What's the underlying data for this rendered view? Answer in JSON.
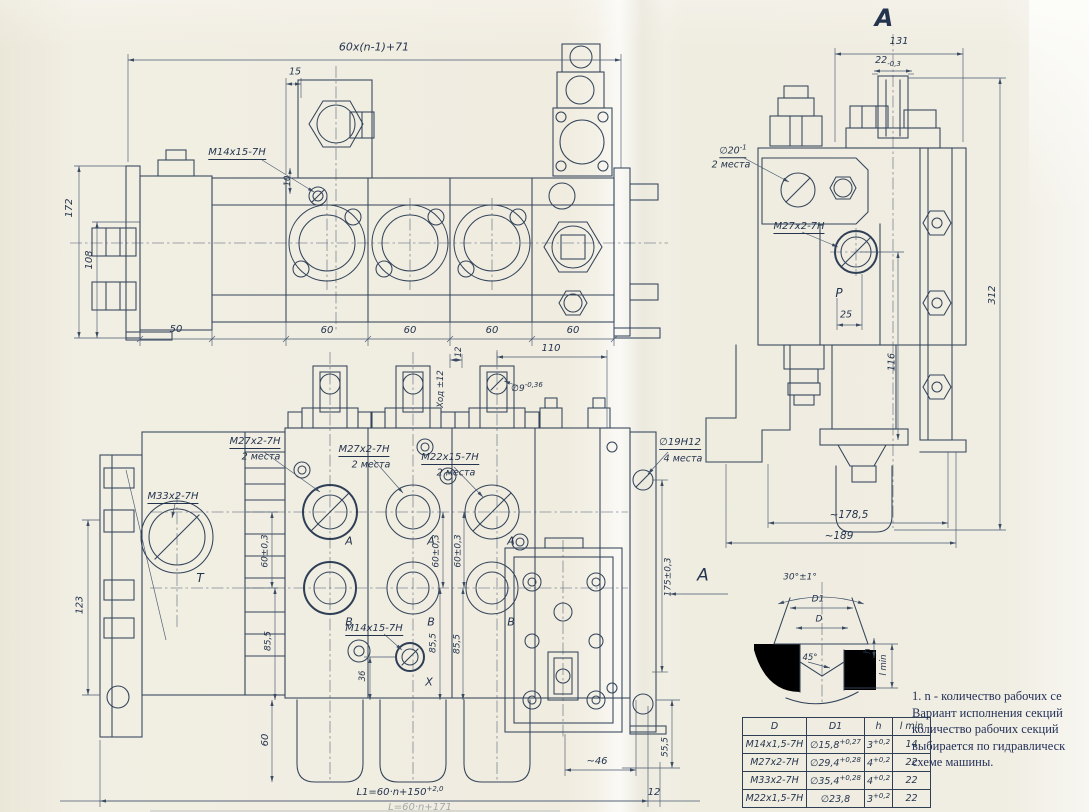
{
  "front": {
    "dim_overall": "60x(n-1)+71",
    "dim_15": "15",
    "callout_m14": "M14x15-7H",
    "dim_10": "10",
    "dim_172": "172",
    "dim_108": "108",
    "dim_50": "50",
    "dim_60": "60"
  },
  "view_a": {
    "title": "A",
    "dim_131": "131",
    "dim_22": "22",
    "dim_22_tol": "-0,3",
    "callout_d20": "∅20",
    "callout_d20_tol": "-1",
    "places_2": "2 места",
    "callout_m27": "M27x2-7H",
    "port_p": "P",
    "dim_25": "25",
    "dim_116": "116",
    "dim_312": "312",
    "dim_178": "~178,5",
    "dim_189": "~189"
  },
  "plan": {
    "dim_110": "110",
    "dim_12": "12",
    "dim_stroke": "Ход ±12",
    "callout_d9": "∅9",
    "callout_d9_tol": "-0,36",
    "callout_m27": "M27x2-7H",
    "callout_m22": "M22x15-7H",
    "callout_m33": "M33x2-7H",
    "callout_m14": "M14x15-7H",
    "callout_d19": "∅19H12",
    "places_2": "2 места",
    "places_4": "4 места",
    "port_t": "T",
    "port_a": "A",
    "port_b": "B",
    "port_x": "X",
    "dim_60_03": "60±0,3",
    "dim_175_03": "175±0,3",
    "dim_123": "123",
    "dim_85_5": "85,5",
    "dim_36": "36",
    "dim_60": "60",
    "dim_55_5": "55,5",
    "dim_46": "~46",
    "dim_12b": "12",
    "dim_l1": "L1=60·n+150",
    "dim_l1_tol": "+2,0",
    "dim_l2": "L=60·n+171"
  },
  "detail": {
    "angle_30": "30°±1°",
    "d1": "D1",
    "d": "D",
    "angle_45": "45°",
    "h": "h",
    "l_min": "l min"
  },
  "arrow_a": {
    "label": "A"
  },
  "table": {
    "headers": {
      "d": "D",
      "d1": "D1",
      "h": "h",
      "lmin": "l min"
    },
    "rows": [
      {
        "d": "M14x1,5-7H",
        "d1": "∅15,8",
        "d1_tol": "+0,27",
        "h": "3",
        "h_tol": "+0,2",
        "lmin": "14"
      },
      {
        "d": "M27x2-7H",
        "d1": "∅29,4",
        "d1_tol": "+0,28",
        "h": "4",
        "h_tol": "+0,2",
        "lmin": "22"
      },
      {
        "d": "M33x2-7H",
        "d1": "∅35,4",
        "d1_tol": "+0,28",
        "h": "4",
        "h_tol": "+0,2",
        "lmin": "22"
      },
      {
        "d": "M22x1,5-7H",
        "d1": "∅23,8",
        "d1_tol": "",
        "h": "3",
        "h_tol": "+0,2",
        "lmin": "22"
      }
    ]
  },
  "notes": {
    "line1": "1. n - количество рабочих се",
    "line2": "Вариант исполнения секций",
    "line3": "количество рабочих секций",
    "line4": "выбирается по гидравлическ",
    "line5": "схеме машины."
  }
}
